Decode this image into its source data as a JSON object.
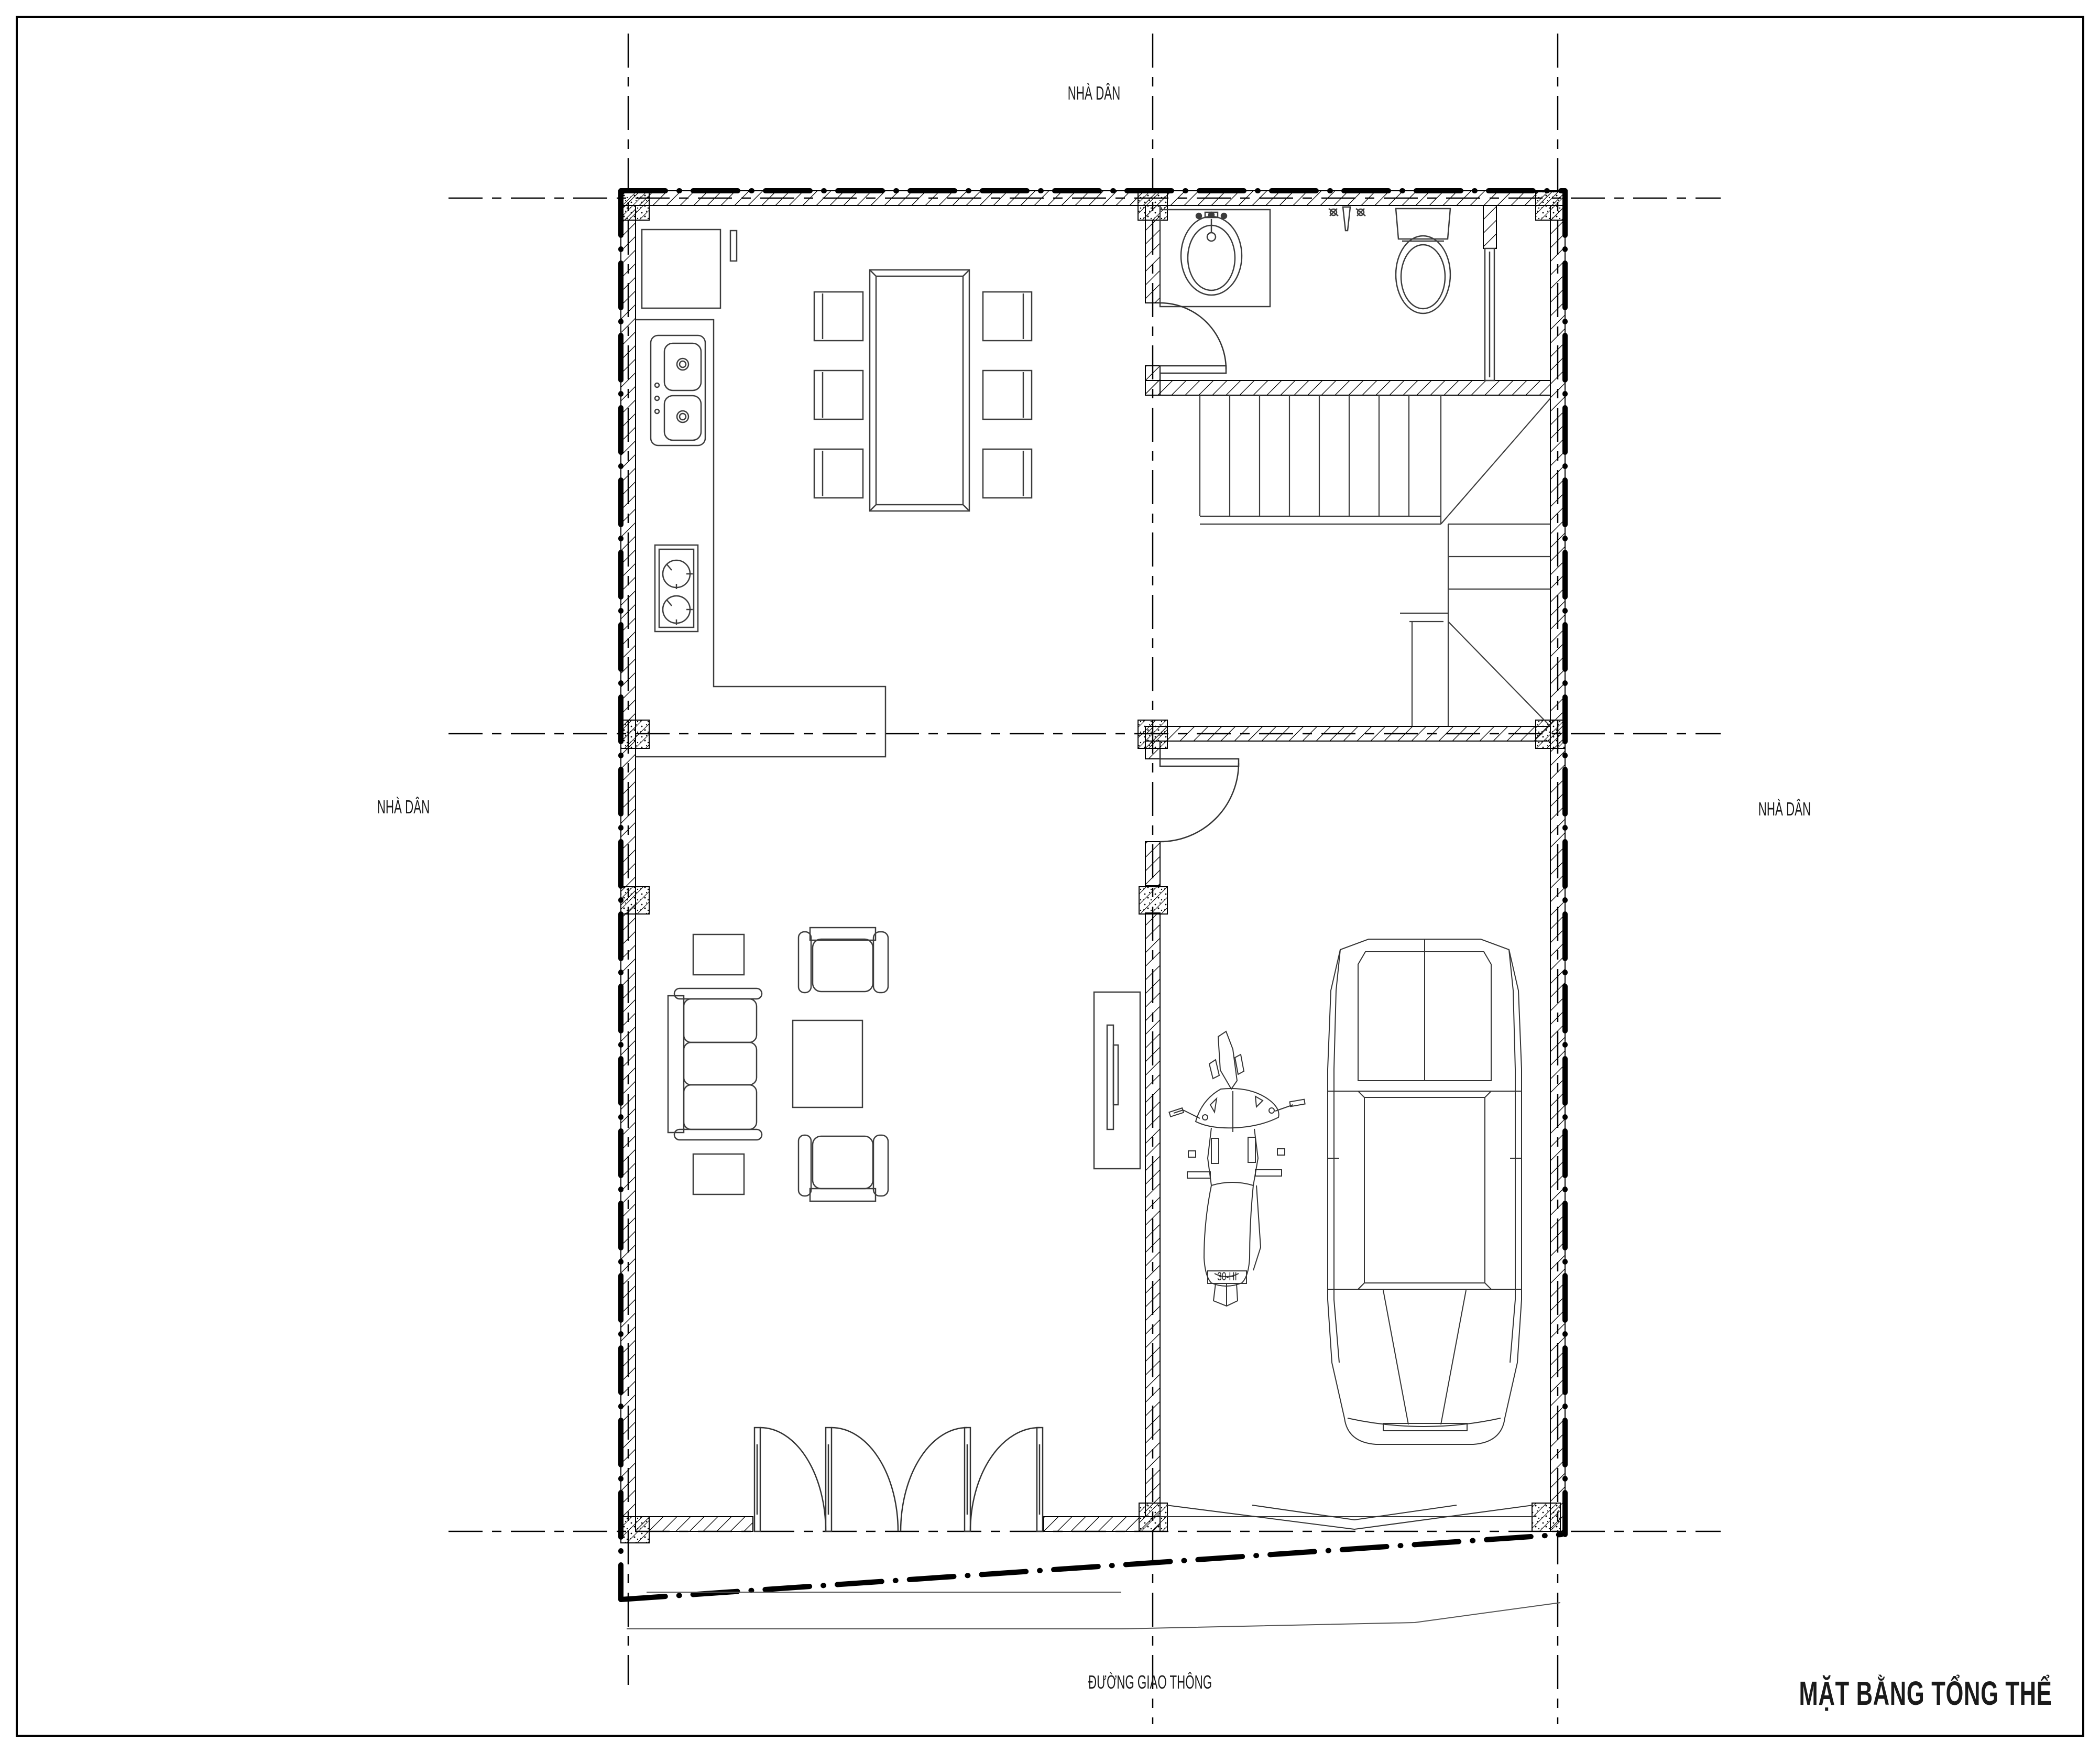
{
  "page": {
    "background": "#ffffff",
    "line_color": "#000000",
    "furniture_color": "#3c3c3c"
  },
  "labels": {
    "neighbor_top": "NHÀ DÂN",
    "neighbor_left": "NHÀ DÂN",
    "neighbor_right": "NHÀ DÂN",
    "road": "ĐƯỜNG GIAO THÔNG",
    "title": "MẶT BẰNG TỔNG THỂ",
    "motorbike_plate": "30-HI"
  }
}
